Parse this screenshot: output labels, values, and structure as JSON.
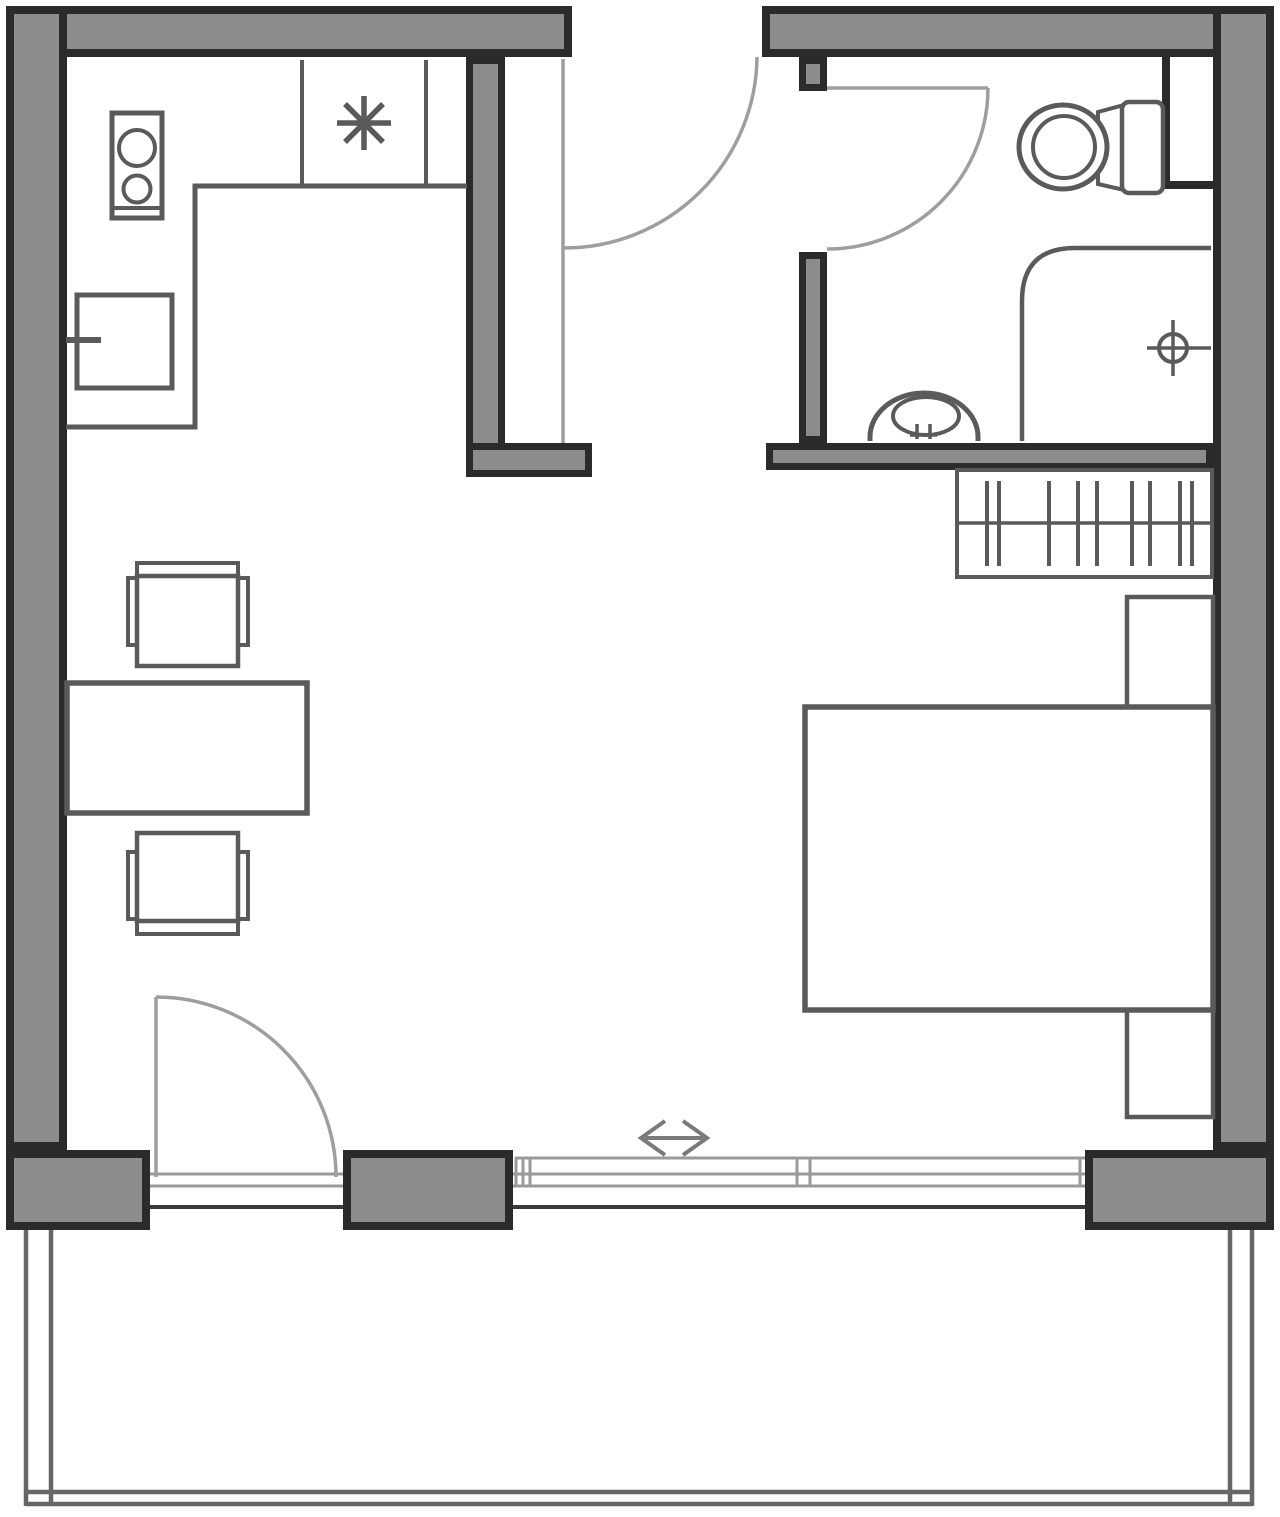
{
  "document": {
    "kind": "studio-apartment-floor-plan",
    "width_px": 1280,
    "height_px": 1517
  },
  "colors": {
    "background": "#ffffff",
    "wall_fill": "#8c8c8c",
    "wall_outline": "#2b2b2b",
    "fixture_stroke": "#5a5a5a",
    "door_swing": "#9e9e9e",
    "window_frame": "#9a9a9a",
    "window_sill": "#3a3a3a",
    "railing": "#666666",
    "arrow": "#7a7a7a"
  },
  "fixtures": [
    "stove-icon",
    "kitchen-sink-icon",
    "appliance-asterisk-icon",
    "kitchen-counter-icon",
    "toilet-icon",
    "washbasin-icon",
    "shower-icon",
    "floor-drain-icon",
    "wardrobe-hangers-icon",
    "double-bed-icon",
    "nightstand-icon",
    "dining-table-icon",
    "chair-icon",
    "door-swing-icon",
    "sliding-door-icon",
    "balcony-railing-icon"
  ],
  "glyphs": {
    "sliding_direction_arrow": "↔",
    "appliance_symbol": "✳"
  }
}
